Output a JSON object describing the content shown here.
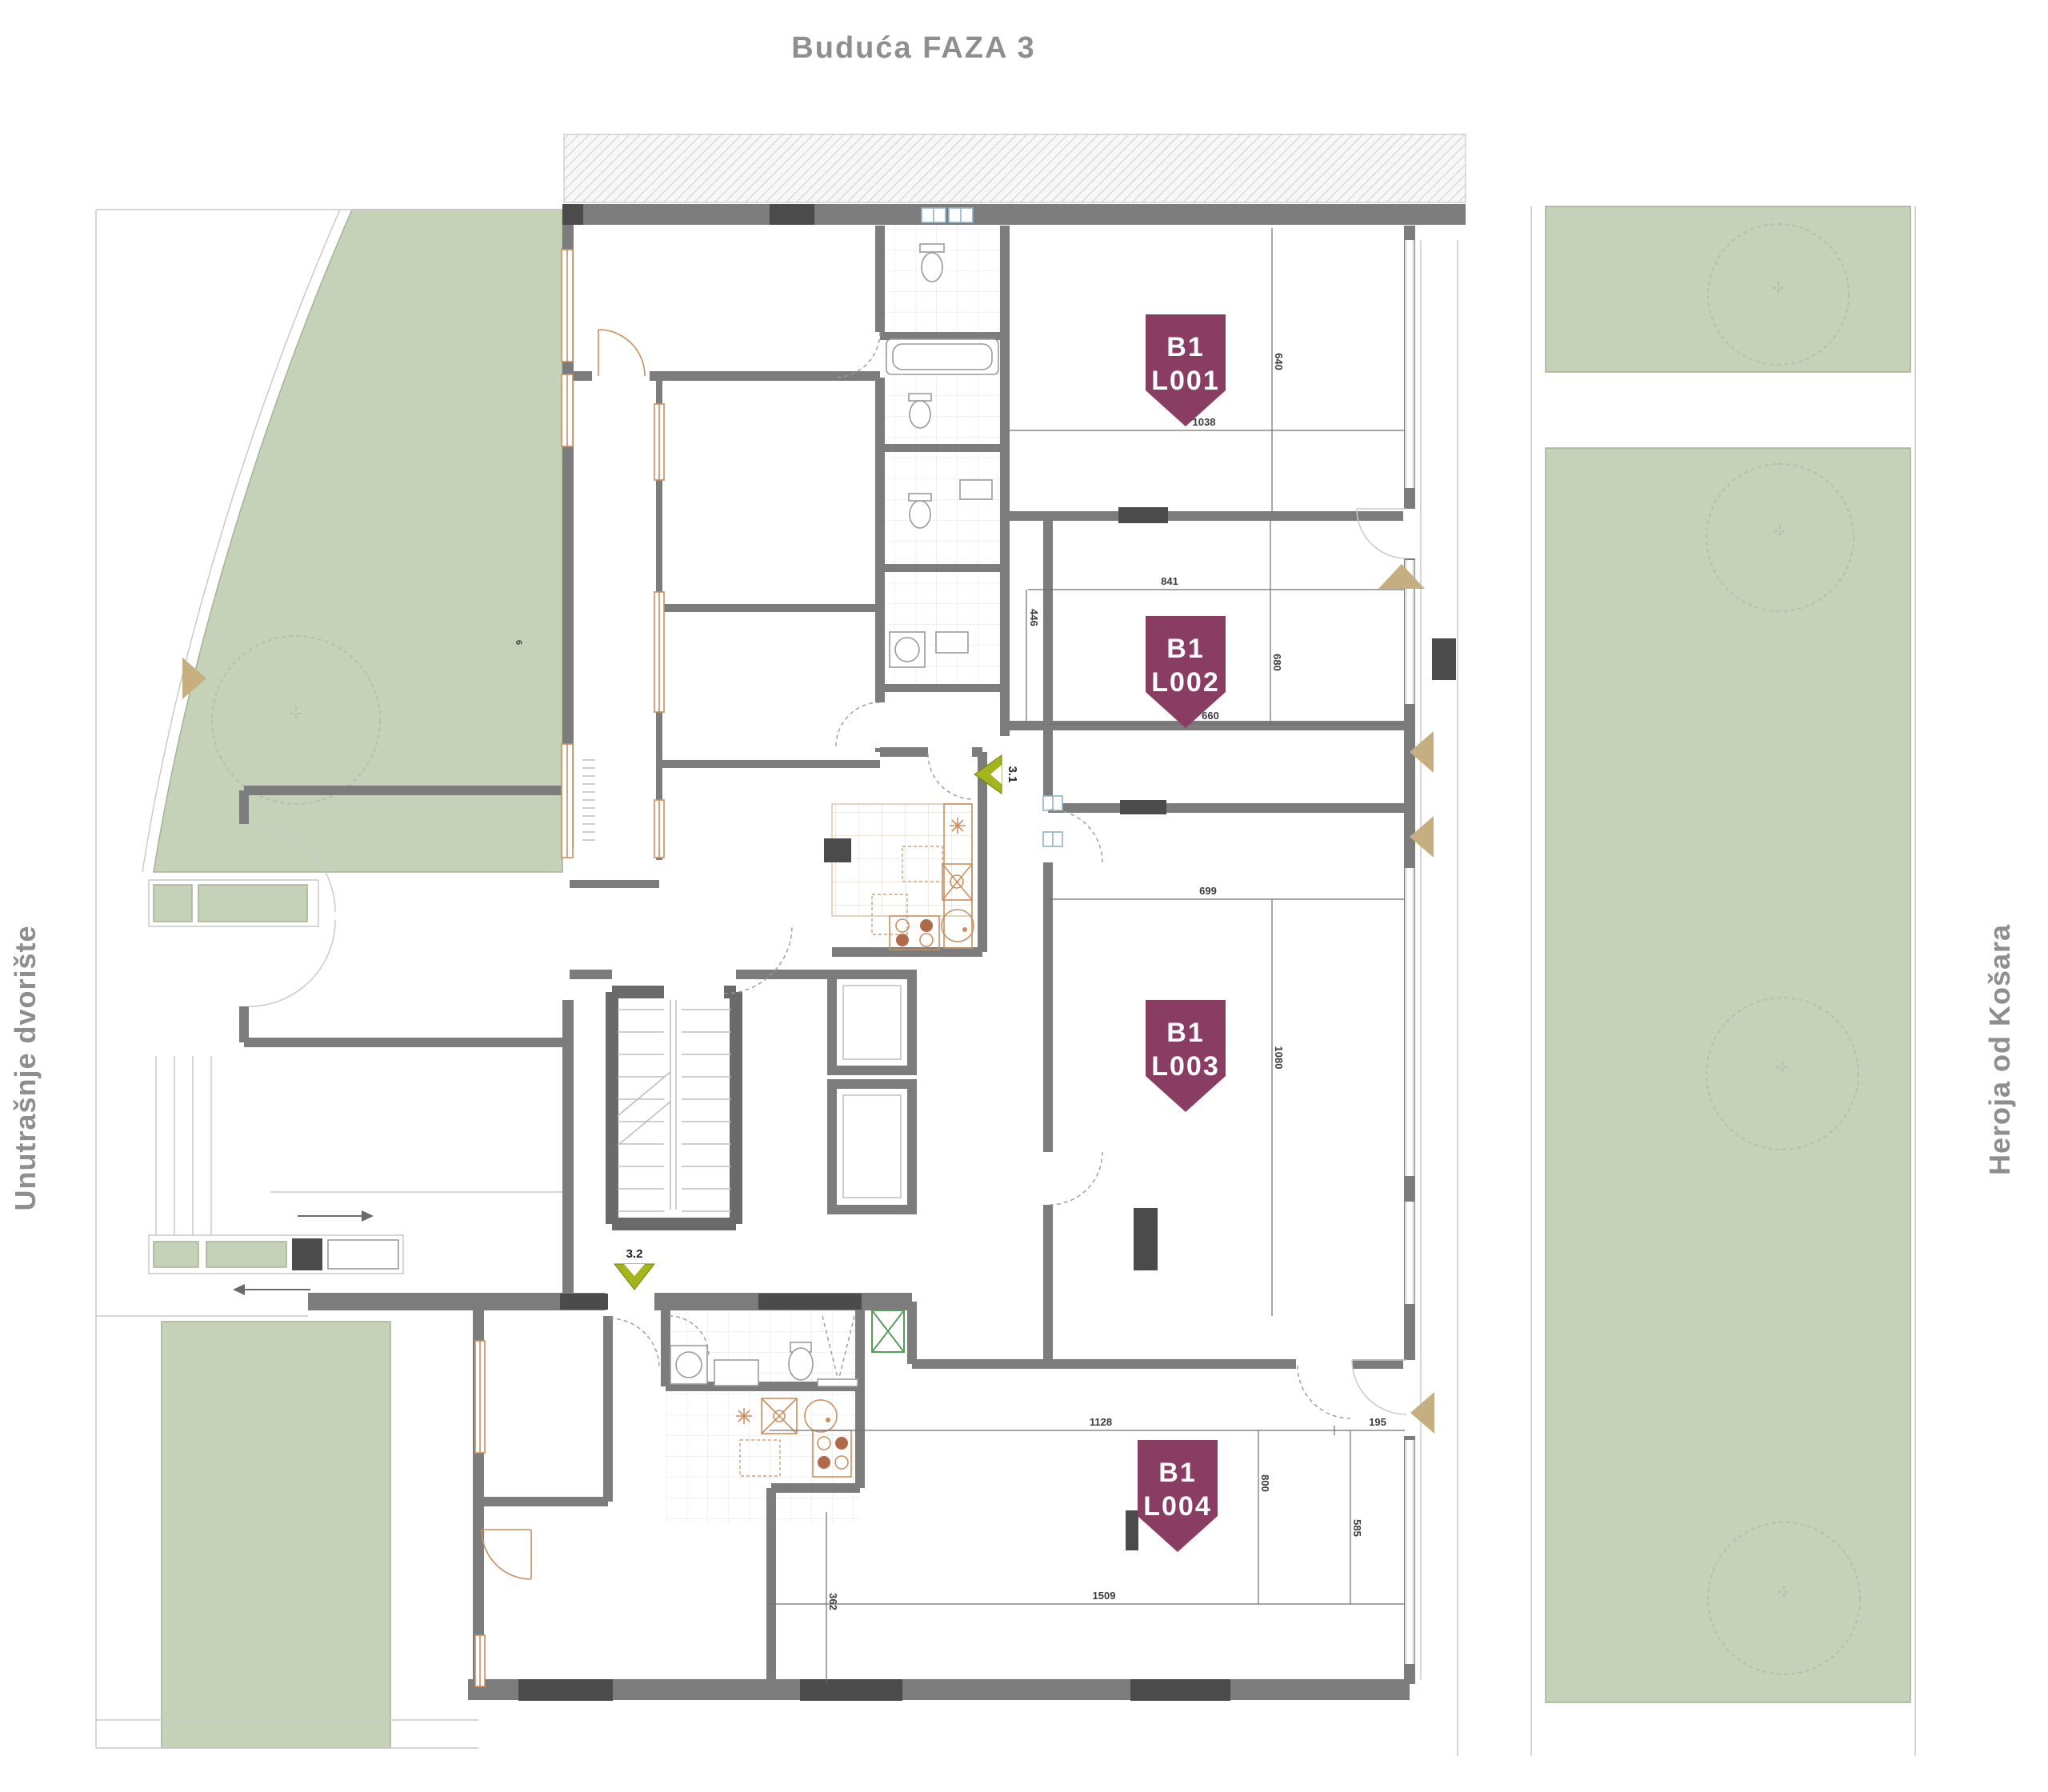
{
  "plan": {
    "title": "Buduća FAZA 3",
    "street_left": "Unutrašnje dvorište",
    "street_right": "Heroja od Košara",
    "green_area_label": "6"
  },
  "units": {
    "l001": {
      "building": "B1",
      "label": "L001"
    },
    "l002": {
      "building": "B1",
      "label": "L002"
    },
    "l003": {
      "building": "B1",
      "label": "L003"
    },
    "l004": {
      "building": "B1",
      "label": "L004"
    }
  },
  "markers": {
    "m31": "3.1",
    "m32": "3.2"
  },
  "dims": {
    "l001_w": "1038",
    "l001_h": "640",
    "l002_w": "841",
    "l002_l": "446",
    "l002_r": "680",
    "l002_b": "660",
    "l003_w": "699",
    "l003_r": "1080",
    "l004_t": "1128",
    "l004_tr": "195",
    "l004_m": "800",
    "l004_r": "585",
    "l004_b": "1509",
    "l004_l": "362"
  },
  "colors": {
    "badge": "#8a3d63",
    "green": "#c6d2b8",
    "green_border": "#a5b296",
    "wall": "#7c7c7c",
    "wall_dark": "#4b4b4b",
    "tan": "#c5ae80",
    "olive": "#a3b41d",
    "window_orange": "#c98f5f",
    "text_gray": "#8e8e8e"
  }
}
